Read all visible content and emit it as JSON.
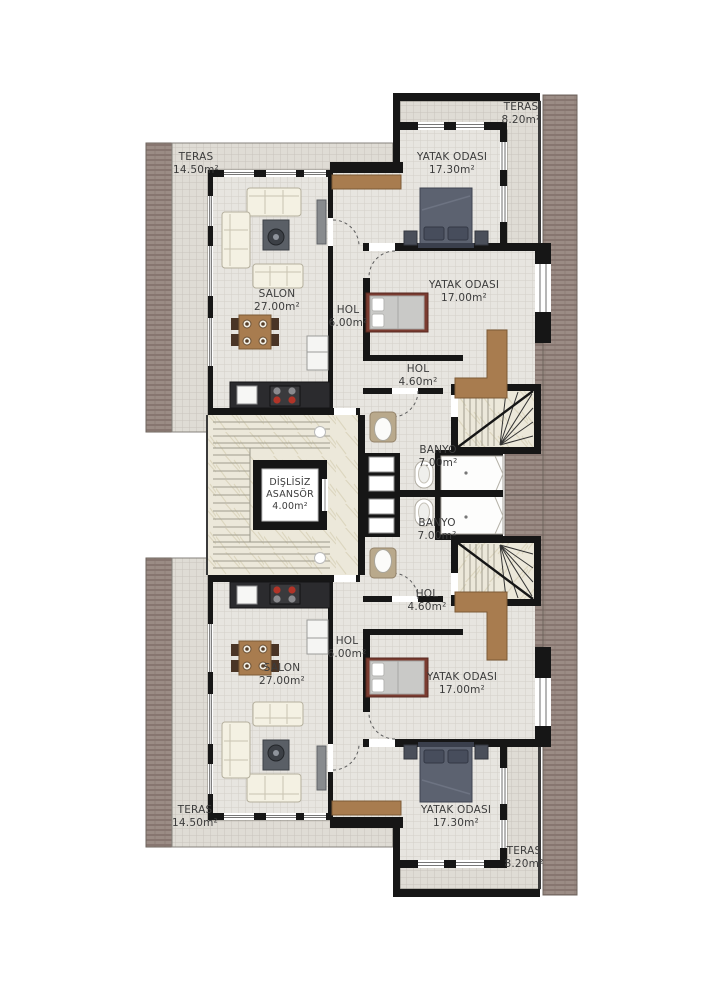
{
  "page": {
    "type": "architectural floor plan",
    "language": "Turkish"
  },
  "colors": {
    "wall": "#161616",
    "interior_tile": "#e7e5e0",
    "terrace_tile": "#dfdcd5",
    "roof_tile": "#9b8c85",
    "stair_marble": "#ece8da",
    "wood": "#a87c4f",
    "label_text": "#3c3c3c"
  },
  "rooms": [
    {
      "id": "teras-top-right",
      "name": "TERAS",
      "area": "8.20m²"
    },
    {
      "id": "teras-top-left",
      "name": "TERAS",
      "area": "14.50m²"
    },
    {
      "id": "yatak-odasi-top",
      "name": "YATAK ODASI",
      "area": "17.30m²"
    },
    {
      "id": "salon-top",
      "name": "SALON",
      "area": "27.00m²"
    },
    {
      "id": "hol-top",
      "name": "HOL",
      "area": "6.00m²"
    },
    {
      "id": "yatak-odasi-mid-top",
      "name": "YATAK ODASI",
      "area": "17.00m²"
    },
    {
      "id": "hol-small-top",
      "name": "HOL",
      "area": "4.60m²"
    },
    {
      "id": "banyo-top",
      "name": "BANYO",
      "area": "7.00m²"
    },
    {
      "id": "banyo-bottom",
      "name": "BANYO",
      "area": "7.00m²"
    },
    {
      "id": "hol-small-bottom",
      "name": "HOL",
      "area": "4.60m²"
    },
    {
      "id": "hol-bottom",
      "name": "HOL",
      "area": "6.00m²"
    },
    {
      "id": "salon-bottom",
      "name": "SALON",
      "area": "27.00m²"
    },
    {
      "id": "yatak-odasi-mid-bottom",
      "name": "YATAK ODASI",
      "area": "17.00m²"
    },
    {
      "id": "yatak-odasi-bottom",
      "name": "YATAK ODASI",
      "area": "17.30m²"
    },
    {
      "id": "teras-bottom-left",
      "name": "TERAS",
      "area": "14.50m²"
    },
    {
      "id": "teras-bottom-right",
      "name": "TERAS",
      "area": "8.20m²"
    }
  ],
  "elevator": {
    "line1": "DİŞLİSİZ",
    "line2": "ASANSÖR",
    "area": "4.00m²"
  }
}
